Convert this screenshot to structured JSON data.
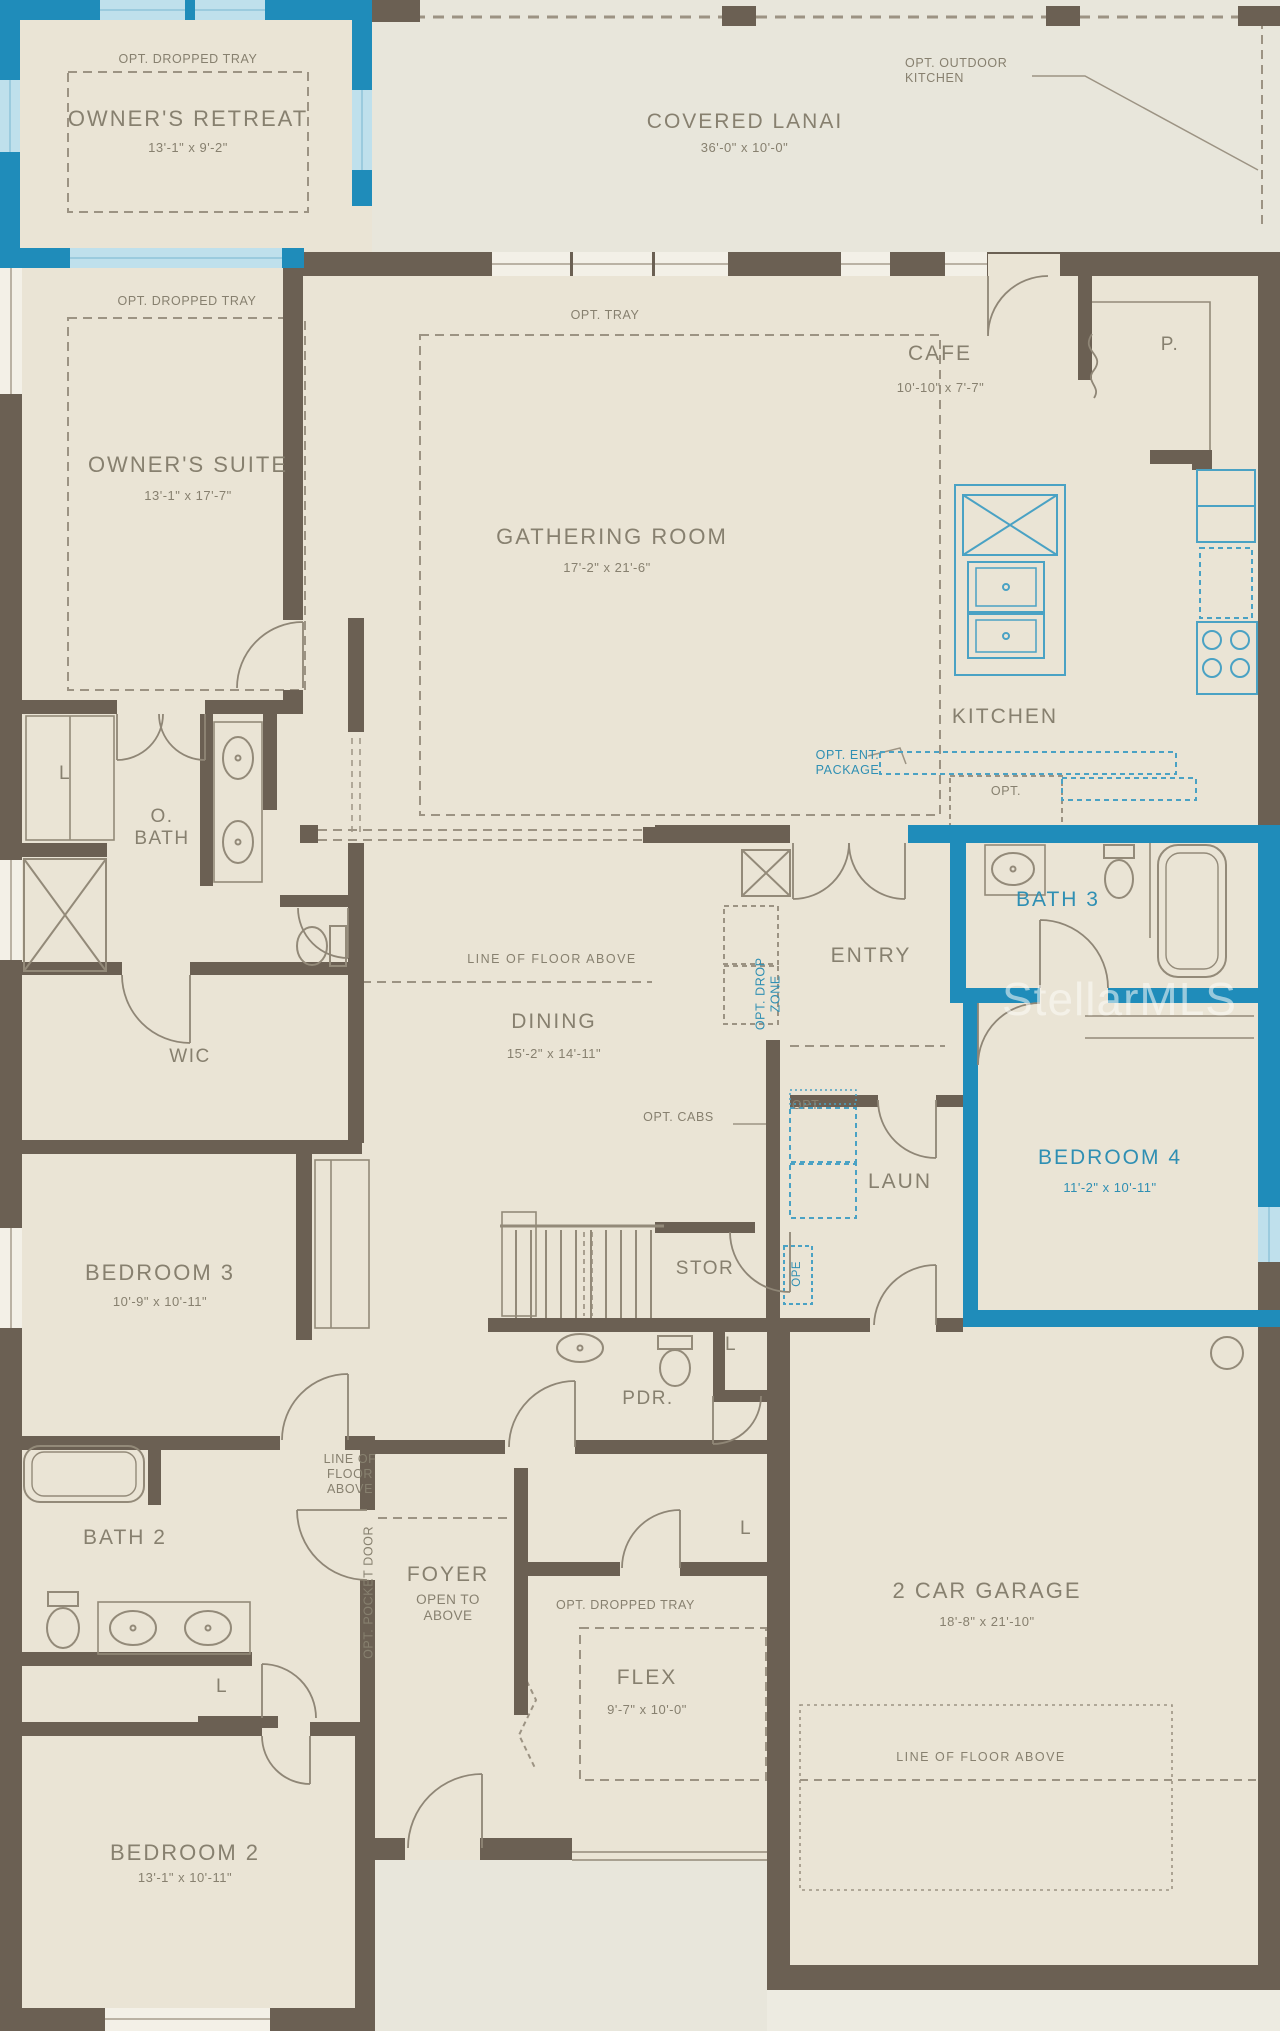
{
  "colors": {
    "wall_brown": "#6b6053",
    "highlight_blue": "#1f8cba",
    "label_gray": "#87806f",
    "label_blue": "#2f8fb3",
    "background": "#eae4d5"
  },
  "watermark": "StellarMLS",
  "closet_label": "L",
  "rooms": {
    "owners_retreat": {
      "opt": "OPT. DROPPED TRAY",
      "name": "OWNER'S RETREAT",
      "dims": "13'-1\" x 9'-2\""
    },
    "covered_lanai": {
      "name": "COVERED LANAI",
      "dims": "36'-0\" x 10'-0\"",
      "opt_outdoor_kitchen": "OPT. OUTDOOR\nKITCHEN"
    },
    "owners_suite": {
      "opt": "OPT. DROPPED TRAY",
      "name": "OWNER'S SUITE",
      "dims": "13'-1\" x 17'-7\""
    },
    "gathering_room": {
      "opt": "OPT. TRAY",
      "name": "GATHERING ROOM",
      "dims": "17'-2\" x 21'-6\""
    },
    "cafe": {
      "name": "CAFE",
      "dims": "10'-10\" x 7'-7\""
    },
    "pantry": {
      "name": "P."
    },
    "kitchen": {
      "name": "KITCHEN",
      "opt_ent_package": "OPT. ENT.\nPACKAGE",
      "opt": "OPT."
    },
    "owners_bath": {
      "name": "O.\nBATH"
    },
    "wic": {
      "name": "WIC"
    },
    "dining": {
      "name": "DINING",
      "dims": "15'-2\" x 14'-11\"",
      "floor_note": "LINE OF FLOOR ABOVE"
    },
    "entry": {
      "name": "ENTRY",
      "opt_drop_zone": "OPT. DROP\nZONE"
    },
    "bath3": {
      "name": "BATH 3"
    },
    "bedroom4": {
      "name": "BEDROOM 4",
      "dims": "11'-2\" x 10'-11\""
    },
    "laundry": {
      "name": "LAUN",
      "opt": "OPT.",
      "opt_cabs": "OPT. CABS",
      "ope": "OPE"
    },
    "storage": {
      "name": "STOR"
    },
    "bedroom3": {
      "name": "BEDROOM 3",
      "dims": "10'-9\" x 10'-11\""
    },
    "powder": {
      "name": "PDR."
    },
    "bath2": {
      "name": "BATH 2"
    },
    "foyer": {
      "name": "FOYER",
      "sub": "OPEN TO\nABOVE",
      "floor_note": "LINE OF\nFLOOR\nABOVE",
      "opt_pocket_door": "OPT. POCKET DOOR"
    },
    "flex": {
      "opt": "OPT. DROPPED TRAY",
      "name": "FLEX",
      "dims": "9'-7\" x 10'-0\""
    },
    "garage": {
      "name": "2 CAR GARAGE",
      "dims": "18'-8\" x 21'-10\"",
      "floor_note": "LINE OF FLOOR ABOVE"
    },
    "bedroom2": {
      "name": "BEDROOM 2",
      "dims": "13'-1\" x 10'-11\""
    }
  }
}
